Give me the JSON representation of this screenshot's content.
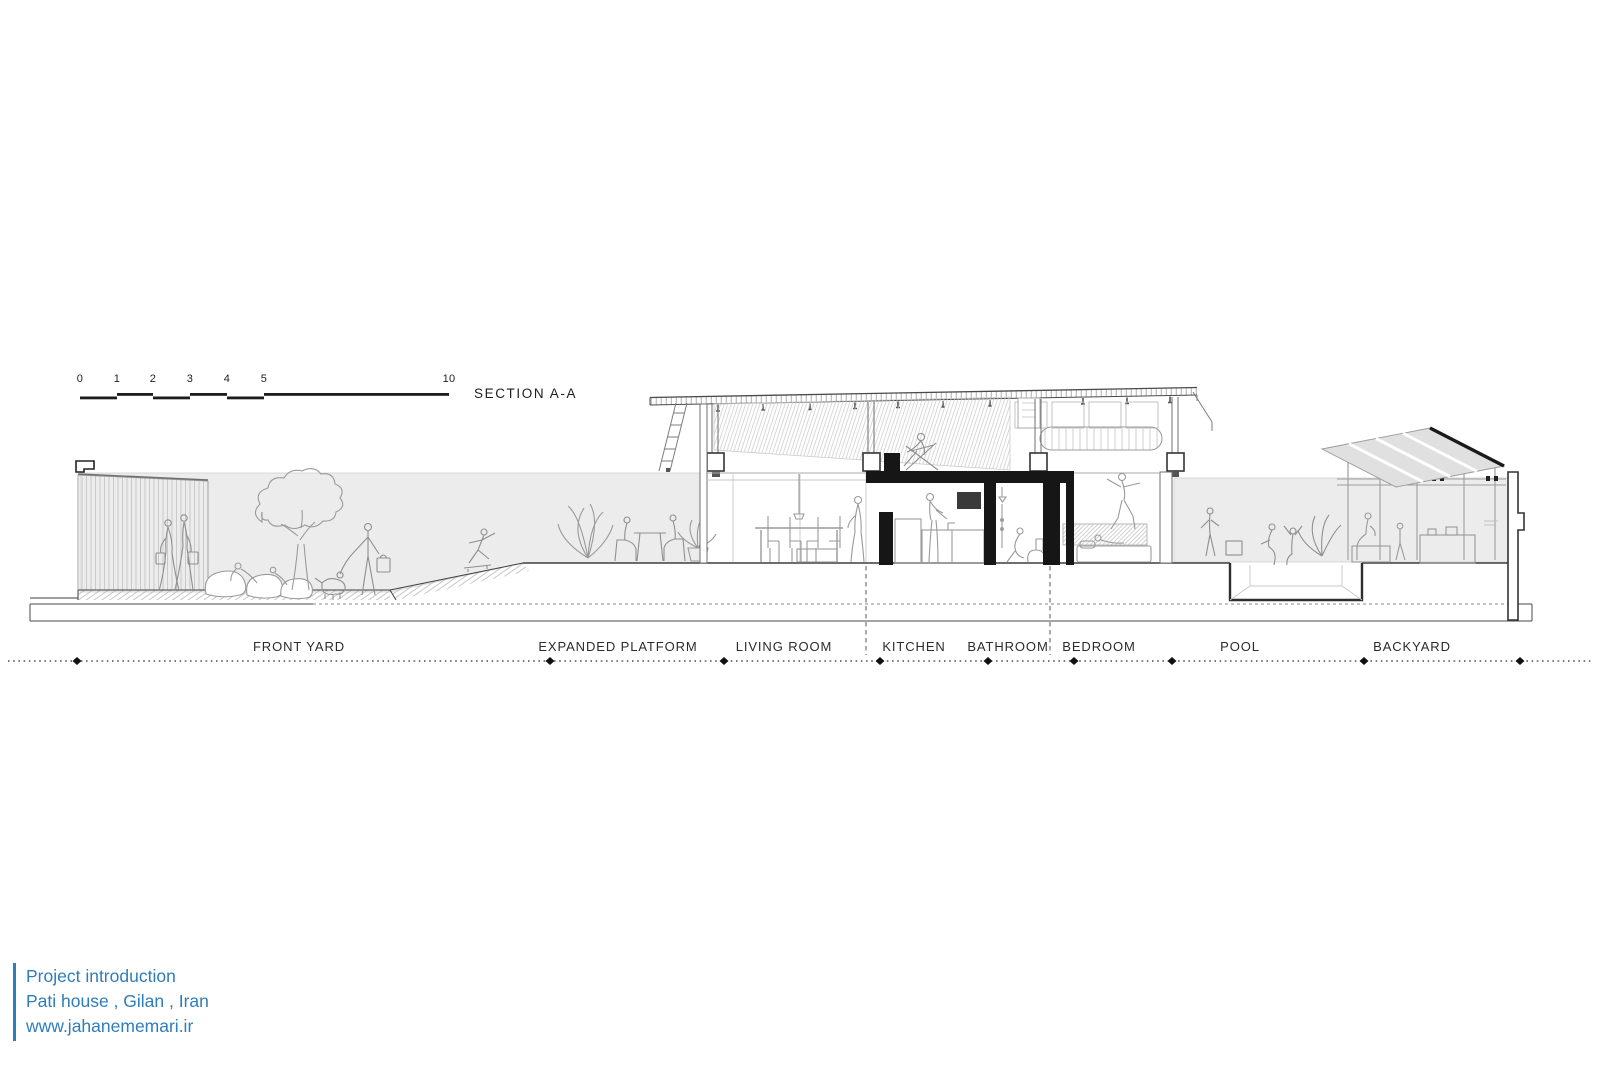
{
  "drawing": {
    "title": "SECTION A-A",
    "scale_ticks": [
      "0",
      "1",
      "2",
      "3",
      "4",
      "5",
      "10"
    ]
  },
  "zones": [
    {
      "label": "FRONT YARD"
    },
    {
      "label": "EXPANDED PLATFORM"
    },
    {
      "label": "LIVING ROOM"
    },
    {
      "label": "KITCHEN"
    },
    {
      "label": "BATHROOM"
    },
    {
      "label": "BEDROOM"
    },
    {
      "label": "POOL"
    },
    {
      "label": "BACKYARD"
    }
  ],
  "project": {
    "intro": "Project introduction",
    "name": "Pati house , Gilan , Iran",
    "website": "www.jahanememari.ir"
  },
  "colors": {
    "accent_blue": "#2e7dbc",
    "poche_black": "#161616",
    "backdrop_gray": "#ececec",
    "line_dark": "#3f3f3f",
    "line_light": "#b5b5b5"
  }
}
